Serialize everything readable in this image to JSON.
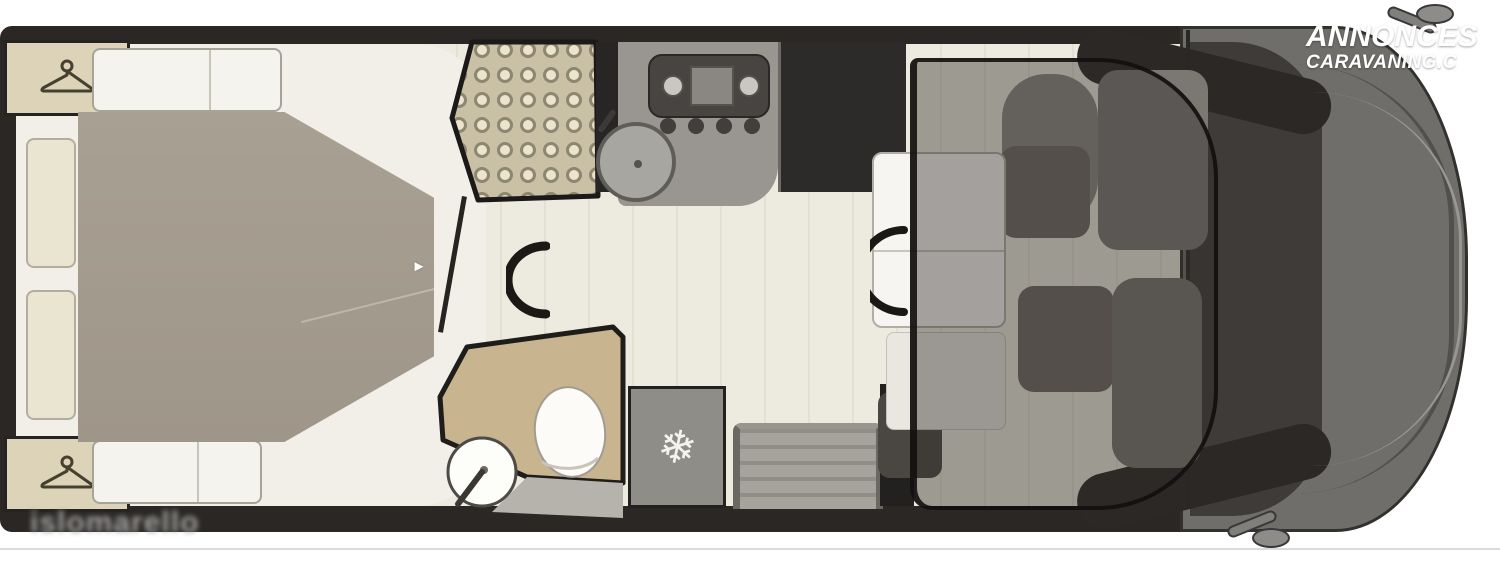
{
  "watermark": {
    "line1": "ANNONCES",
    "line2": "CARAVANING.C"
  },
  "footer": {
    "logo_text": "islomarello"
  },
  "glyphs": {
    "snowflake": "❄",
    "bed_extend_arrow": "►"
  },
  "colors": {
    "body_wall": "#2a2725",
    "floor": "#edeadf",
    "bed_mattress": "#a49b8f",
    "wardrobe": "#dcd3b9",
    "shower_tile": "#c9c0a6",
    "kitchen_counter": "#999691",
    "tall_unit": "#2d2b29",
    "bathroom_vanity": "#c8b48e",
    "fridge": "#8f8d88",
    "seats": "#6e6a65",
    "cab_body": "#6f6e6a",
    "windshield": "#3e3b38",
    "dropdown_bed_overlay": "rgba(48,44,41,0.42)",
    "watermark_text": "#ffffff"
  }
}
